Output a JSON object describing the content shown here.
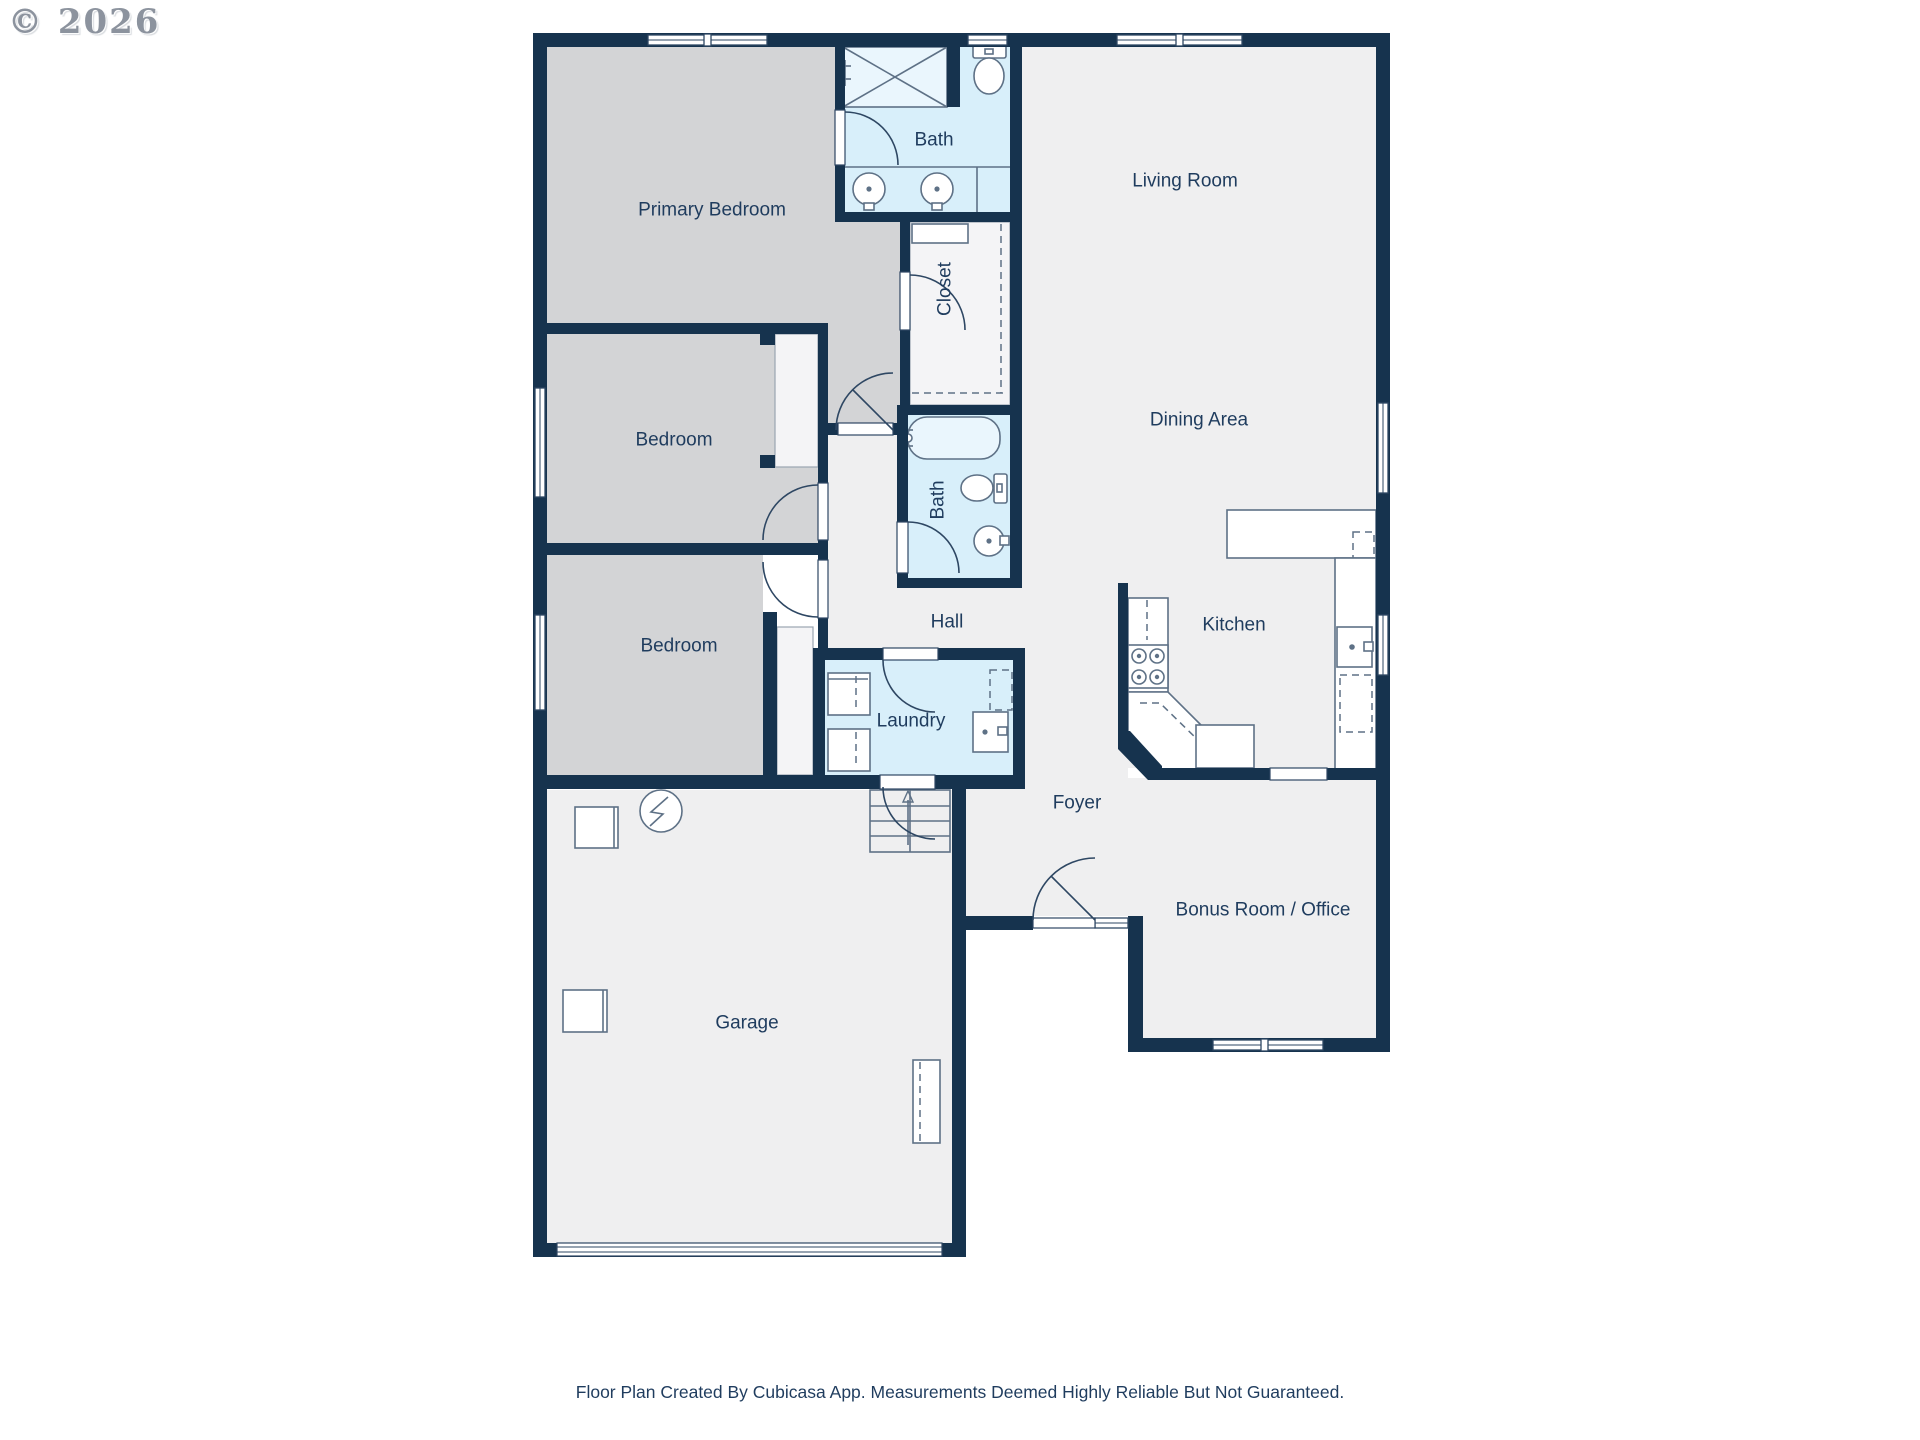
{
  "watermark": {
    "text": "© 2026"
  },
  "footer": {
    "text": "Floor Plan Created By Cubicasa App. Measurements Deemed Highly Reliable But Not Guaranteed."
  },
  "colors": {
    "wall": "#16334E",
    "room_fill": "#EFEFF0",
    "bedroom_fill": "#D3D4D6",
    "wet_fill": "#D8EFFA",
    "fixture_stroke": "#5E7186",
    "label_text": "#1F3C5E",
    "watermark_text": "#8C939E"
  },
  "rooms": [
    {
      "id": "primary-bedroom",
      "label": "Primary Bedroom"
    },
    {
      "id": "bath-primary",
      "label": "Bath"
    },
    {
      "id": "living-room",
      "label": "Living Room"
    },
    {
      "id": "closet",
      "label": "Closet"
    },
    {
      "id": "bedroom-1",
      "label": "Bedroom"
    },
    {
      "id": "dining-area",
      "label": "Dining Area"
    },
    {
      "id": "bath-hall",
      "label": "Bath"
    },
    {
      "id": "hall",
      "label": "Hall"
    },
    {
      "id": "bedroom-2",
      "label": "Bedroom"
    },
    {
      "id": "kitchen",
      "label": "Kitchen"
    },
    {
      "id": "laundry",
      "label": "Laundry"
    },
    {
      "id": "foyer",
      "label": "Foyer"
    },
    {
      "id": "bonus-room",
      "label": "Bonus Room / Office"
    },
    {
      "id": "garage",
      "label": "Garage"
    }
  ]
}
